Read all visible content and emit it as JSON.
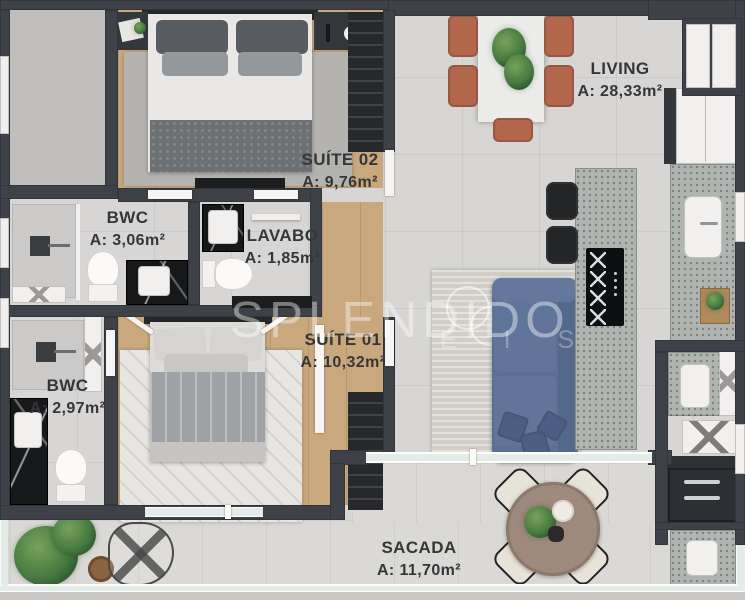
{
  "rooms": {
    "suite02": {
      "label": "SUÍTE 02",
      "area": "A: 9,76m²"
    },
    "bwc_top": {
      "label": "BWC",
      "area": "A: 3,06m²"
    },
    "lavabo": {
      "label": "LAVABO",
      "area": "A: 1,85m²"
    },
    "suite01": {
      "label": "SUÍTE 01",
      "area": "A: 10,32m²"
    },
    "bwc_bottom": {
      "label": "BWC",
      "area": "A: 2,97m²"
    },
    "living": {
      "label": "LIVING",
      "area": "A: 28,33m²"
    },
    "sacada": {
      "label": "SACADA",
      "area": "A: 11,70m²"
    }
  },
  "watermark": {
    "brand": "SPLENDIDO",
    "partial": "E I S"
  },
  "colors": {
    "wall": "#3e4147",
    "floor": "#d7d6d4",
    "wood": "#c9a87e",
    "sofa": "#5b7094",
    "dining_chair": "#b2674d",
    "granite": "#b0b5b2",
    "black_marble": "#17181a",
    "rug_living": "#d2cec7",
    "balcony_table": "#9d8a7c",
    "plant": "#2f5a32",
    "glass": "#e3ece8"
  }
}
